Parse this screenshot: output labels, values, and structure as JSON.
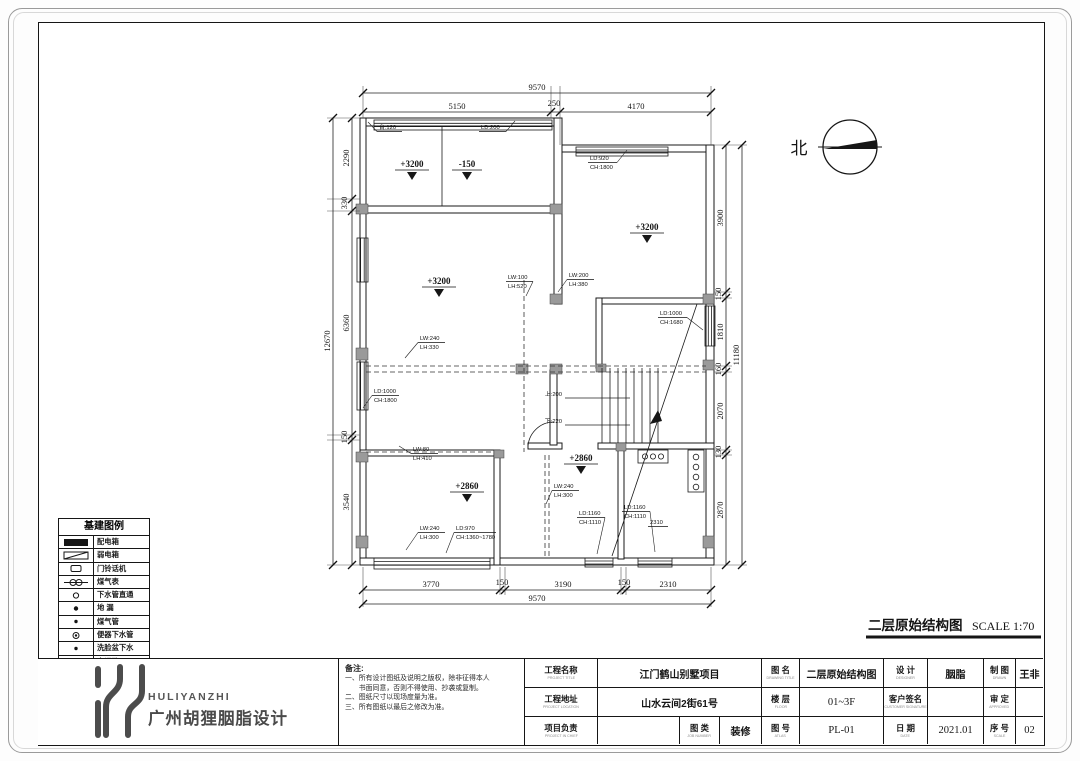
{
  "page": {
    "plan_title": "二层原始结构图",
    "plan_scale": "SCALE 1:70",
    "north_label": "北"
  },
  "dims": {
    "top": [
      "9570",
      "5150",
      "250",
      "4170"
    ],
    "bottom": [
      "3770",
      "150",
      "3190",
      "150",
      "2310",
      "9570"
    ],
    "left": [
      "12670",
      "2290",
      "330",
      "6360",
      "150",
      "3540"
    ],
    "right": [
      "3900",
      "150",
      "1810",
      "160",
      "2070",
      "130",
      "2870",
      "11180"
    ]
  },
  "levels": [
    "+3200",
    "-150",
    "+3200",
    "+3200",
    "+2860",
    "+2860"
  ],
  "ann": [
    [
      "台:120"
    ],
    [
      "LD:200"
    ],
    [
      "LD:920",
      "CH:1800"
    ],
    [
      "LW:100",
      "LH:520"
    ],
    [
      "LW:200",
      "LH:380"
    ],
    [
      "LD:1000",
      "CH:1680"
    ],
    [
      "LW:240",
      "LH:330"
    ],
    [
      "LD:1000",
      "CH:1800"
    ],
    [
      "LW:80",
      "LH:410"
    ],
    [
      "LW:240",
      "LH:300"
    ],
    [
      "LD:970",
      "CH:1360~1780"
    ],
    [
      "LW:240",
      "LH:300"
    ],
    [
      "LD:1160",
      "CH:1110"
    ],
    [
      "LD:1160",
      "CH:1110"
    ],
    [
      "2310"
    ]
  ],
  "stair": {
    "up": "上:200",
    "down": "下:220"
  },
  "legend": {
    "title": "基建图例",
    "items": [
      {
        "label": "配电箱"
      },
      {
        "label": "弱电箱"
      },
      {
        "label": "门铃话机"
      },
      {
        "label": "煤气表"
      },
      {
        "label": "下水管直通"
      },
      {
        "label": "地 漏"
      },
      {
        "label": "煤气管"
      },
      {
        "label": "便器下水管"
      },
      {
        "label": "洗脸盆下水"
      },
      {
        "label": "空调孔"
      }
    ]
  },
  "notes": {
    "title": "备注:",
    "lines": [
      "一、所有设计图纸及说明之版权，除非征得本人",
      "　　书面同意，否则不得使用、抄袭或复制。",
      "二、图纸尺寸以现场度量为准。",
      "三、所有图纸以最后之修改为准。"
    ]
  },
  "logo": {
    "en": "HULIYANZHI",
    "cn": "广州胡狸胭脂设计"
  },
  "titleblock": {
    "row1": [
      {
        "label": "工程名称",
        "sub": "PROJECT TITLE",
        "value": "江门鹤山别墅项目"
      },
      {
        "label": "图 名",
        "sub": "DRAWING TITLE",
        "value": "二层原始结构图"
      },
      {
        "label": "设 计",
        "sub": "DESIGNER",
        "value": "胭脂"
      },
      {
        "label": "制 图",
        "sub": "DRAWN",
        "value": "王非"
      }
    ],
    "row2": [
      {
        "label": "工程地址",
        "sub": "PROJECT LOCATION",
        "value": "山水云间2街61号"
      },
      {
        "label": "楼 层",
        "sub": "FLOOR",
        "value": "01~3F"
      },
      {
        "label": "客户签名",
        "sub": "CUSTOMER SIGNATURE",
        "value": ""
      },
      {
        "label": "审 定",
        "sub": "APPROVED",
        "value": ""
      }
    ],
    "row3": [
      {
        "label": "项目负责",
        "sub": "PROJECT IN CHIEF",
        "value": ""
      },
      {
        "label": "图 类",
        "sub": "JOB NUMBER",
        "value": "装修"
      },
      {
        "label": "图 号",
        "sub": "ATLAS",
        "value": "PL-01"
      },
      {
        "label": "日 期",
        "sub": "DATE",
        "value": "2021.01"
      },
      {
        "label": "序 号",
        "sub": "SCALE",
        "value": "02"
      }
    ]
  }
}
